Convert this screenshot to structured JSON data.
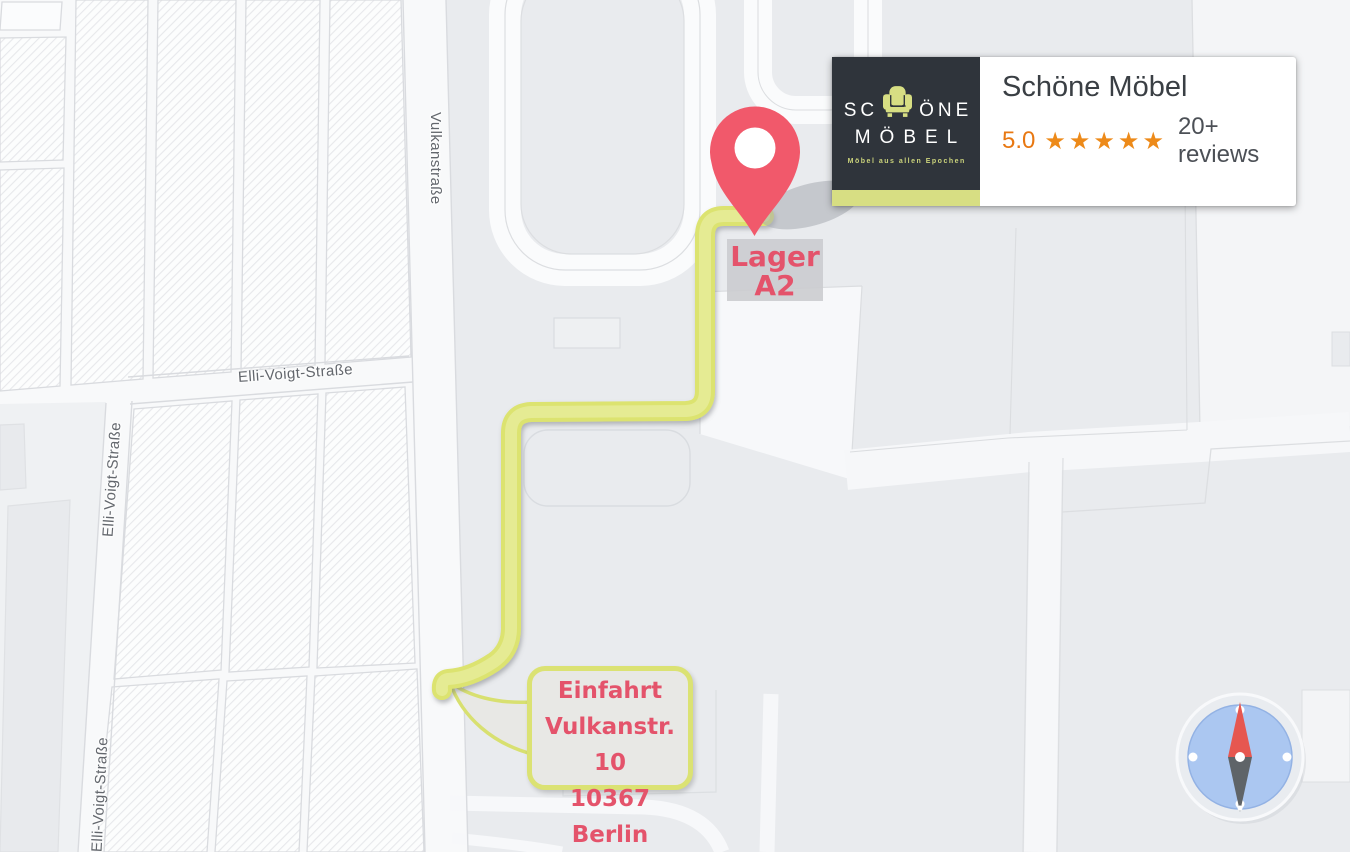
{
  "map": {
    "street_labels": {
      "vulkanstrasse": "Vulkanstraße",
      "elli_voigt_strasse": "Elli-Voigt-Straße"
    },
    "colors": {
      "route": "#dce36f",
      "road_white": "#fafbfc",
      "block_gray": "#e9ebee",
      "accent_text_red": "#e4536b"
    }
  },
  "destination": {
    "pin_color": "#f1596b",
    "label_line1": "Lager",
    "label_line2": "A2"
  },
  "entrance": {
    "line1": "Einfahrt",
    "line2": "Vulkanstr. 10",
    "line3": "10367 Berlin"
  },
  "business_card": {
    "logo": {
      "text_before_icon": "SC",
      "text_after_icon": "ÖNE",
      "line2": "MÖBEL",
      "tagline": "Möbel aus allen Epochen",
      "brand_yellow": "#d7de83",
      "background": "#2f343b"
    },
    "title": "Schöne Möbel",
    "rating": {
      "score": "5.0",
      "stars": "★★★★★",
      "reviews": "20+ reviews",
      "orange": "#e87812"
    }
  },
  "compass": {
    "needle_north_color": "#e65750",
    "needle_south_color": "#5f6468",
    "dial_blue": "#abc7f1"
  }
}
